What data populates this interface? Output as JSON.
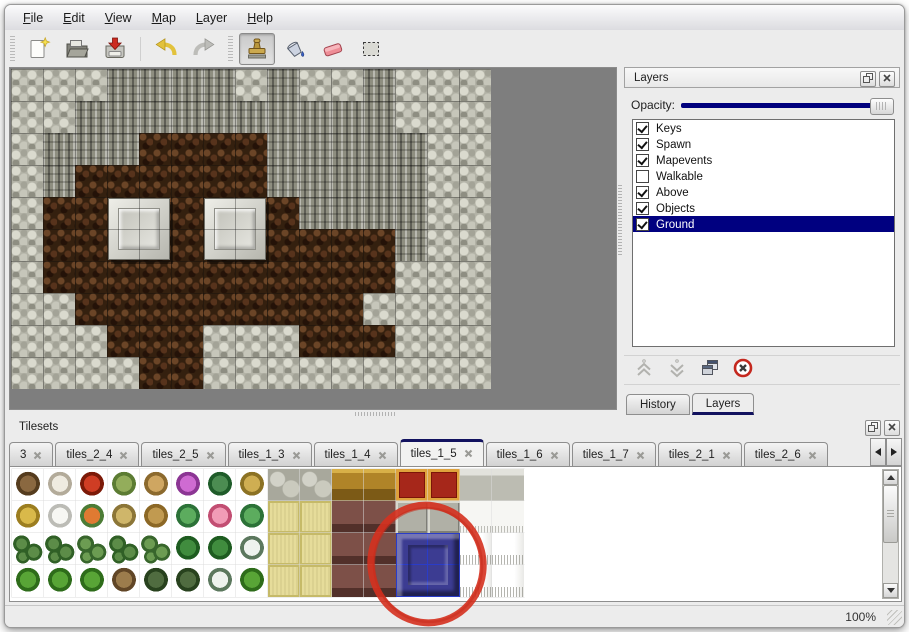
{
  "menubar": {
    "items": [
      "File",
      "Edit",
      "View",
      "Map",
      "Layer",
      "Help"
    ]
  },
  "toolbar": {
    "buttons": [
      {
        "name": "new",
        "icon": "new-file-icon",
        "active": false
      },
      {
        "name": "open",
        "icon": "open-folder-icon",
        "active": false
      },
      {
        "name": "save",
        "icon": "save-icon",
        "active": false
      },
      {
        "name": "undo",
        "icon": "undo-icon",
        "active": false
      },
      {
        "name": "redo",
        "icon": "redo-icon",
        "active": false
      },
      {
        "name": "stamp",
        "icon": "stamp-tool-icon",
        "active": true
      },
      {
        "name": "fill",
        "icon": "fill-bucket-icon",
        "active": false
      },
      {
        "name": "eraser",
        "icon": "eraser-icon",
        "active": false
      },
      {
        "name": "select",
        "icon": "select-rect-icon",
        "active": false
      }
    ]
  },
  "map_canvas": {
    "tile_size": 32,
    "legend": {
      "s": "light-stone-scales",
      "c": "cliff-rock",
      "f": "dark-brown-floor"
    },
    "grid": [
      "sssccccscsscsss",
      "ssccccccccccsss",
      "scccffffcccccss",
      "scffffffcccccss",
      "sffffffffccccss",
      "sfffffffffffcss",
      "sfffffffffffsss",
      "ssfffffffffssss",
      "sssfffsssfffsss",
      "ssssffsssssssss"
    ],
    "platforms": [
      {
        "col": 3,
        "row": 4
      },
      {
        "col": 6,
        "row": 4
      }
    ]
  },
  "layers_panel": {
    "title": "Layers",
    "opacity_label": "Opacity:",
    "opacity_percent": 100,
    "layers": [
      {
        "name": "Keys",
        "checked": true,
        "selected": false
      },
      {
        "name": "Spawn",
        "checked": true,
        "selected": false
      },
      {
        "name": "Mapevents",
        "checked": true,
        "selected": false
      },
      {
        "name": "Walkable",
        "checked": false,
        "selected": false
      },
      {
        "name": "Above",
        "checked": true,
        "selected": false
      },
      {
        "name": "Objects",
        "checked": true,
        "selected": false
      },
      {
        "name": "Ground",
        "checked": true,
        "selected": true
      }
    ],
    "tools": [
      {
        "name": "move-layer-up",
        "icon": "chevron-up-icon",
        "enabled": false
      },
      {
        "name": "move-layer-down",
        "icon": "chevron-down-icon",
        "enabled": false
      },
      {
        "name": "duplicate-layer",
        "icon": "duplicate-icon",
        "enabled": true
      },
      {
        "name": "delete-layer",
        "icon": "delete-icon",
        "enabled": true
      }
    ],
    "bottom_tabs": [
      {
        "label": "History",
        "active": false
      },
      {
        "label": "Layers",
        "active": true
      }
    ]
  },
  "tilesets_panel": {
    "title": "Tilesets",
    "tabs": [
      {
        "label": "3",
        "active": false
      },
      {
        "label": "tiles_2_4",
        "active": false
      },
      {
        "label": "tiles_2_5",
        "active": false
      },
      {
        "label": "tiles_1_3",
        "active": false
      },
      {
        "label": "tiles_1_4",
        "active": false
      },
      {
        "label": "tiles_1_5",
        "active": true
      },
      {
        "label": "tiles_1_6",
        "active": false
      },
      {
        "label": "tiles_1_7",
        "active": false
      },
      {
        "label": "tiles_2_1",
        "active": false
      },
      {
        "label": "tiles_2_6",
        "active": false
      }
    ],
    "tile_rows": [
      [
        "trunk",
        "branch",
        "flower-red",
        "stump",
        "trunk2",
        "flower-purple",
        "fern",
        "plant-dry",
        "stone",
        "stone",
        "gold",
        "gold",
        "carpet",
        "carpet",
        "silver",
        "silver",
        "empty"
      ],
      [
        "hay",
        "snowmound",
        "flowers-orange",
        "grass-dry",
        "leaves",
        "lily",
        "flowers-pink",
        "lily",
        "mat",
        "mat",
        "wood",
        "wood",
        "blockgray",
        "blockgray",
        "white",
        "white",
        "empty"
      ],
      [
        "shrub",
        "shrub",
        "bush",
        "shrub",
        "bush",
        "palm",
        "palm",
        "snowpine",
        "mat",
        "mat",
        "wood",
        "wood",
        "blue",
        "blue",
        "curtain",
        "curtain",
        "empty"
      ],
      [
        "conetree",
        "conetree",
        "conetree",
        "drytree",
        "darktree",
        "darktree",
        "snowpine",
        "conetree",
        "mat",
        "mat",
        "wood",
        "wood",
        "blue",
        "blue",
        "curtain",
        "curtain",
        "empty"
      ]
    ],
    "selected_tile": {
      "cols": [
        12,
        13
      ],
      "rows": [
        2,
        3
      ],
      "color": "#3c3c92",
      "description": "blue beveled block tile (selected)"
    },
    "annotation_circle": {
      "color": "#d5311f"
    }
  },
  "statusbar": {
    "zoom_level": "100%"
  },
  "colors": {
    "selection_navy": "#000080",
    "panel_bg": "#ececec",
    "canvas_gray": "#7e7e7e",
    "tab_accent_navy": "#12125f",
    "annotation_red": "#d5311f"
  }
}
